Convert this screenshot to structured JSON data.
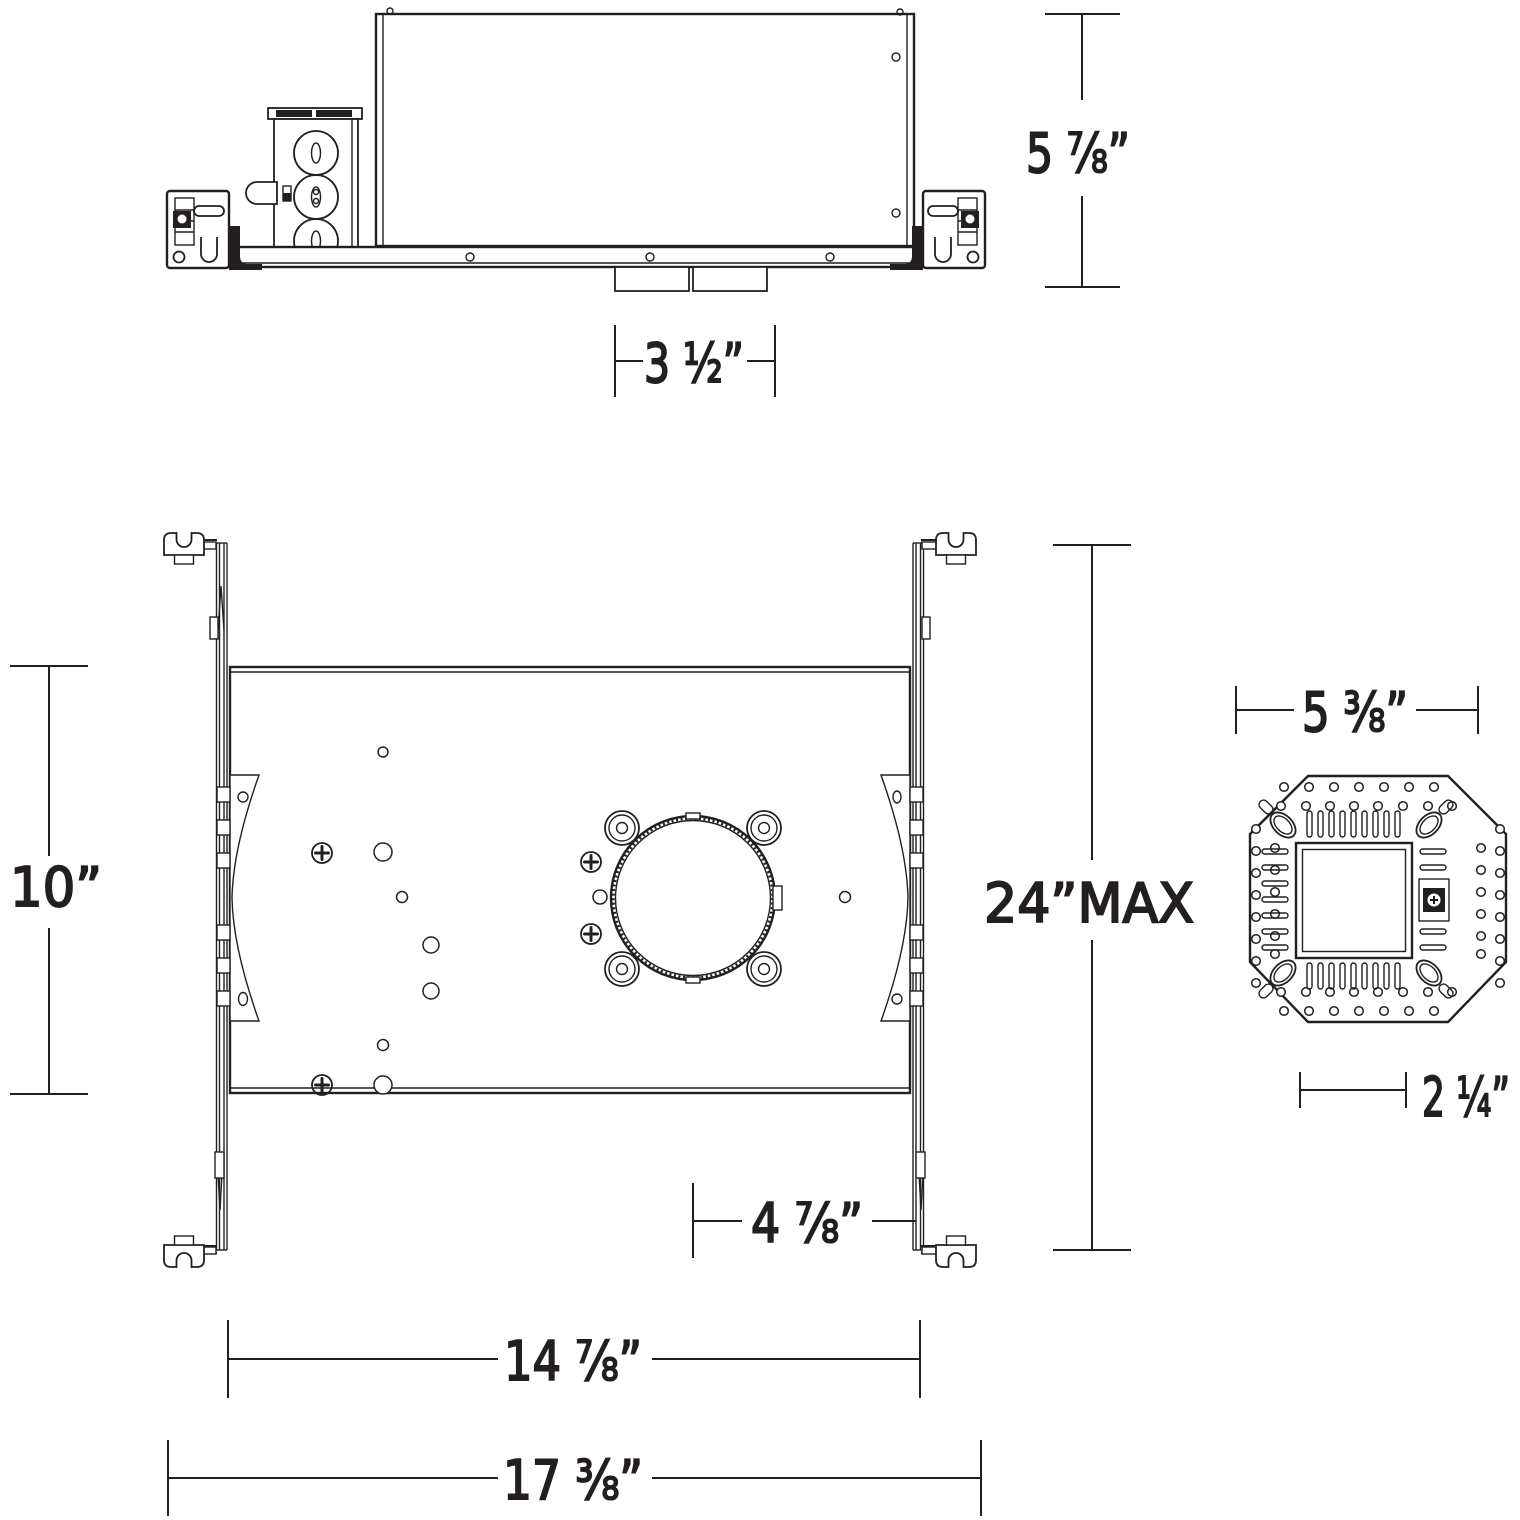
{
  "drawing": {
    "type": "recessed-housing-dimensional-drawing",
    "colors": {
      "line": "#231f20",
      "background": "#ffffff"
    },
    "dimensions": {
      "housing_height": "5 ⅞”",
      "collar_width": "3 ½”",
      "pan_depth": "10”",
      "hanger_bar_span": "24”MAX",
      "aperture_offset": "4 ⅞”",
      "pan_width": "14 ⅞”",
      "overall_width": "17 ⅜”",
      "module_width": "5 ⅜”",
      "module_aperture": "2 ¼”"
    }
  }
}
